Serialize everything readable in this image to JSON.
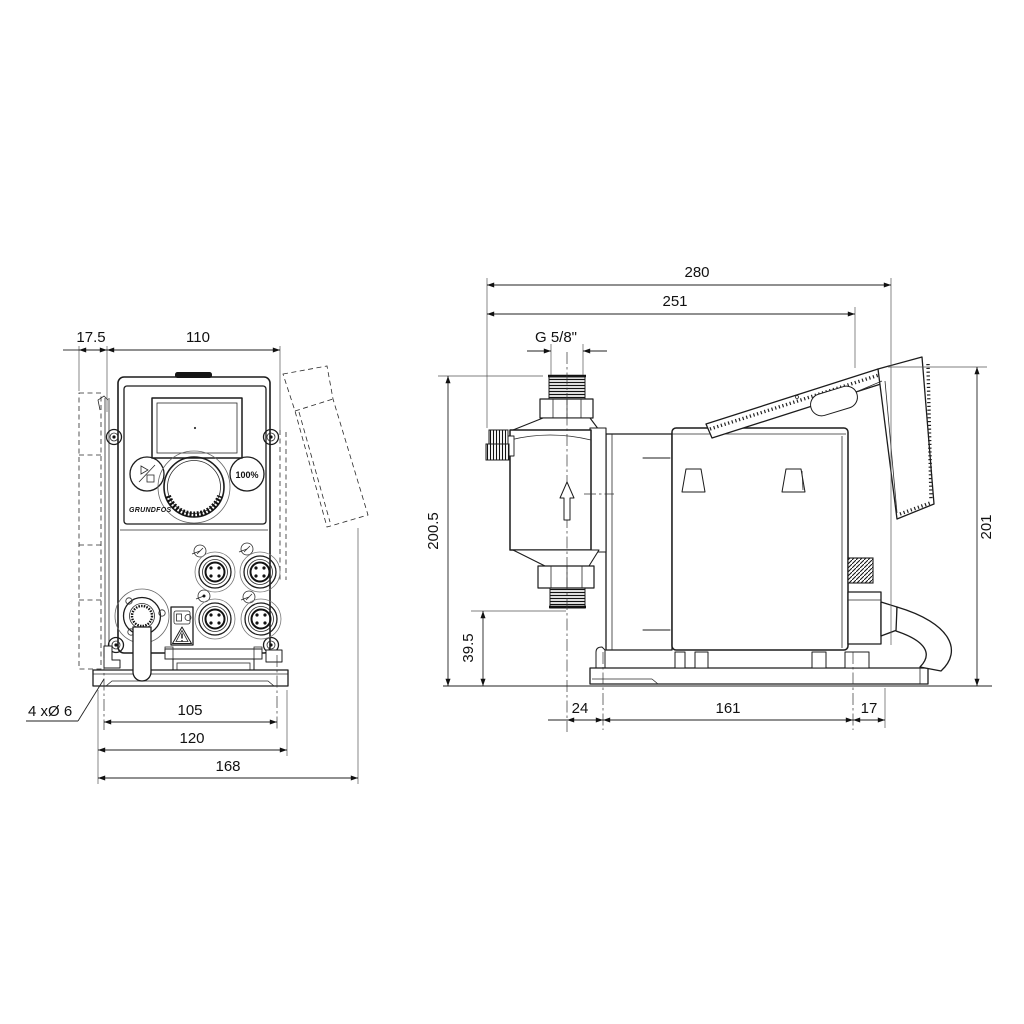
{
  "front_view": {
    "dims": {
      "offset": "17.5",
      "width": "110",
      "hole_pitch": "105",
      "base_width": "120",
      "overall_width": "168",
      "holes_note": "4 xØ 6"
    },
    "panel": {
      "hundred_button": "100%",
      "brand": "GRUNDFOS"
    }
  },
  "side_view": {
    "dims": {
      "overall_depth": "280",
      "depth_to_hinge": "251",
      "thread_size": "G 5/8\"",
      "height": "200.5",
      "valve_height": "39.5",
      "rear_height": "201",
      "front_to_hole": "24",
      "hole_pitch": "161",
      "hole_to_rear": "17"
    }
  },
  "icons": {
    "run_stop": "play-stop-icon",
    "warning": "warning-triangle-icon",
    "flow_direction": "up-arrow-icon"
  }
}
